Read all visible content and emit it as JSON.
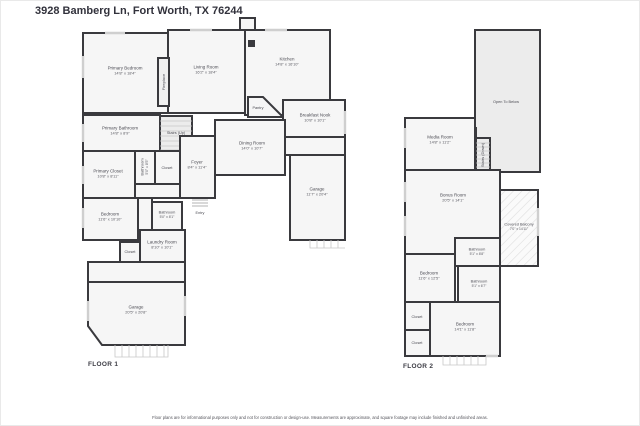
{
  "title": "3928 Bamberg Ln, Fort Worth, TX 76244",
  "footer": "Floor plans are for informational purposes only and not for construction or design-use. Measurements are approximate, and square footage may include finished and unfinished areas.",
  "floor1": {
    "label": "FLOOR 1",
    "rooms": {
      "primary_bedroom": {
        "name": "Primary Bedroom",
        "dims": "14'8\" x 18'4\""
      },
      "fireplace": {
        "name": "Fireplace"
      },
      "living_room": {
        "name": "Living Room",
        "dims": "16'2\" x 18'4\""
      },
      "kitchen": {
        "name": "Kitchen",
        "dims": "14'8\" x 16'10\""
      },
      "pantry": {
        "name": "Pantry"
      },
      "breakfast_nook": {
        "name": "Breakfast Nook",
        "dims": "10'8\" x 10'1\""
      },
      "dining_room": {
        "name": "Dining Room",
        "dims": "14'0\" x 10'7\""
      },
      "garage_right": {
        "name": "Garage",
        "dims": "11'7\" x 20'4\""
      },
      "primary_bathroom": {
        "name": "Primary Bathroom",
        "dims": "14'8\" x 8'9\""
      },
      "stairs_up": {
        "name": "Stairs (Up)"
      },
      "bathroom_mid": {
        "name": "Bathroom",
        "dims": "5'0\" x 8'5\""
      },
      "closet_1": {
        "name": "Closet"
      },
      "primary_closet": {
        "name": "Primary Closet",
        "dims": "10'8\" x 8'11\""
      },
      "foyer": {
        "name": "Foyer",
        "dims": "8'4\" x 11'4\""
      },
      "entry": {
        "name": "Entry"
      },
      "bedroom_1": {
        "name": "Bedroom",
        "dims": "11'6\" x 10'10\""
      },
      "bathroom_1": {
        "name": "Bathroom",
        "dims": "5'0\" x 8'1\""
      },
      "laundry": {
        "name": "Laundry Room",
        "dims": "8'10\" x 10'1\""
      },
      "closet_2": {
        "name": "Closet"
      },
      "garage_bottom": {
        "name": "Garage",
        "dims": "20'5\" x 20'8\""
      }
    }
  },
  "floor2": {
    "label": "FLOOR 2",
    "rooms": {
      "open_below": {
        "name": "Open To Below"
      },
      "media_room": {
        "name": "Media Room",
        "dims": "14'8\" x 11'2\""
      },
      "stairs_down": {
        "name": "Stairs (Down)"
      },
      "bonus_room": {
        "name": "Bonus Room",
        "dims": "20'5\" x 14'1\""
      },
      "covered_balcony": {
        "name": "Covered Balcony",
        "dims": "7'0\" x 14'11\""
      },
      "bathroom_a": {
        "name": "Bathroom",
        "dims": "5'1\" x 8'8\""
      },
      "bedroom_a": {
        "name": "Bedroom",
        "dims": "11'6\" x 12'5\""
      },
      "bathroom_b": {
        "name": "Bathroom",
        "dims": "5'1\" x 6'7\""
      },
      "closet_a": {
        "name": "Closet"
      },
      "bedroom_b": {
        "name": "Bedroom",
        "dims": "14'1\" x 11'8\""
      },
      "closet_b": {
        "name": "Closet"
      }
    }
  }
}
